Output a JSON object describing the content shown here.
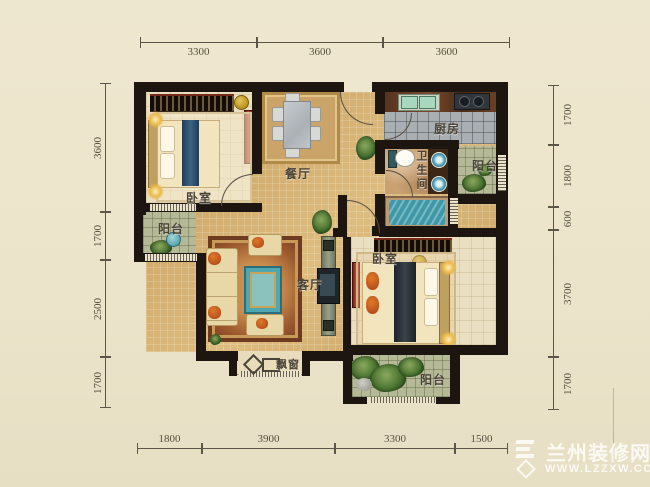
{
  "rooms": {
    "bedroom_left": "卧室",
    "bedroom_right": "卧室",
    "dining": "餐厅",
    "living": "客厅",
    "kitchen": "厨房",
    "bathroom": "卫生间",
    "balcony_left": "阳台",
    "balcony_right": "阳台",
    "balcony_bottom": "阳台",
    "bay_window": "飘窗"
  },
  "dimensions": {
    "top": [
      "3300",
      "3600",
      "3600"
    ],
    "left": [
      "3600",
      "1700",
      "2500",
      "1700"
    ],
    "right": [
      "1700",
      "1800",
      "600",
      "3700",
      "1700"
    ],
    "bottom": [
      "1800",
      "3900",
      "3300",
      "1500"
    ]
  },
  "watermark": {
    "name": "兰州装修网",
    "url": "WWW.LZZXW.COM"
  },
  "colors": {
    "background": "#ece5cc",
    "wall": "#1d1610",
    "floor_gold": "#d4b173",
    "floor_bedroom": "#ebdfc1",
    "kitchen_tile": "#a9aeb3",
    "balcony_tile": "#b6b996",
    "water_teal": "#3f98a8",
    "accent_red": "#a3322a",
    "lamp_yellow": "#d4a92c"
  }
}
